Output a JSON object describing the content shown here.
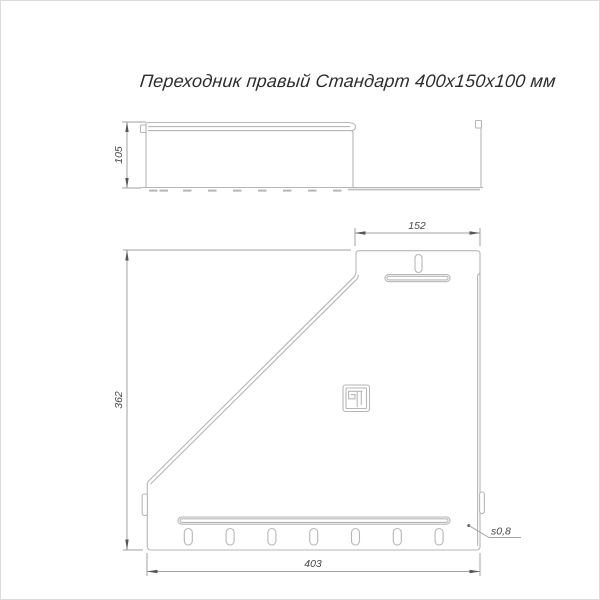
{
  "title": "Переходник правый Стандарт 400х150х100 мм",
  "dimensions": {
    "side_height": "105",
    "flange_width": "152",
    "height": "362",
    "base_width": "403",
    "thickness": "s0,8"
  },
  "icons": {
    "brand_logo": "squared-pilcrow-brand-mark"
  },
  "colors": {
    "background": "#ffffff",
    "part_outline": "#b6b6b6",
    "dimension_lines": "#a2a2a2",
    "dimension_text": "#474747",
    "title_text": "#2d2d2d",
    "frame_border": "#dcdcdc"
  }
}
